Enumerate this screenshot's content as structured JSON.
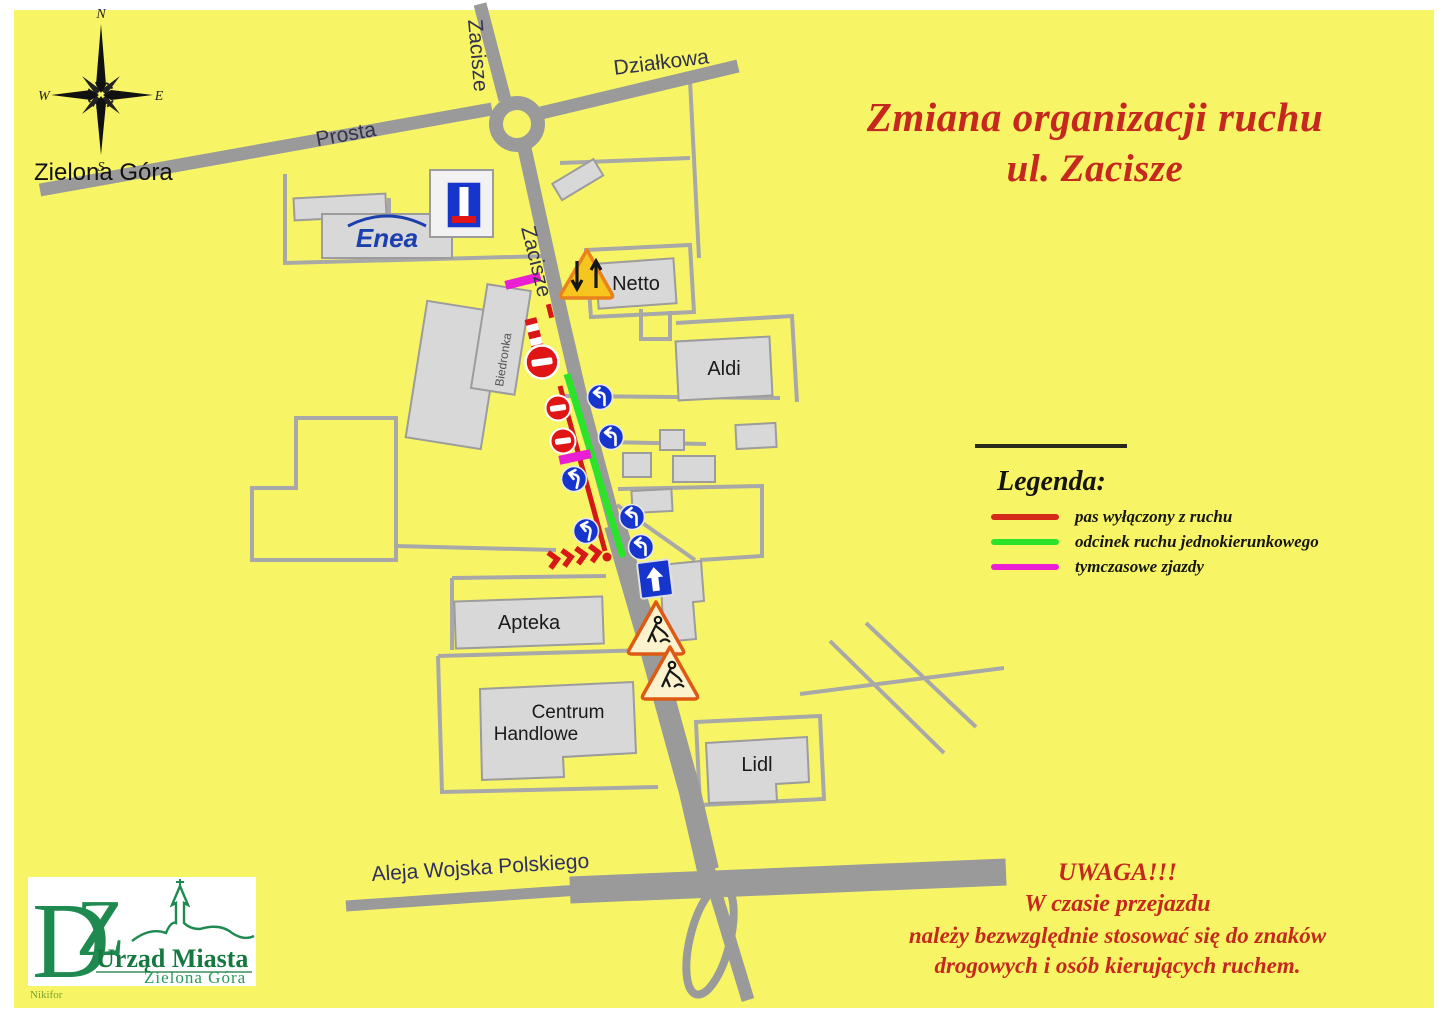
{
  "title": {
    "line1": "Zmiana organizacji ruchu",
    "line2": "ul. Zacisze"
  },
  "city_label": "Zielona Góra",
  "compass": {
    "north": "N",
    "east": "E",
    "south": "S",
    "west": "W"
  },
  "streets": {
    "prosta": "Prosta",
    "zacisze_top": "Zacisze",
    "zacisze_mid": "Zacisze",
    "dzialkowa": "Działkowa",
    "aleja": "Aleja Wojska Polskiego"
  },
  "buildings": {
    "enea": "Enea",
    "biedronka": "Biedronka",
    "netto": "Netto",
    "aldi": "Aldi",
    "apteka": "Apteka",
    "centrum_line1": "Centrum",
    "centrum_line2": "Handlowe",
    "lidl": "Lidl"
  },
  "legend": {
    "title": "Legenda:",
    "items": [
      {
        "color": "#d42a1a",
        "label": "pas wyłączony z ruchu"
      },
      {
        "color": "#2ce32c",
        "label": "odcinek ruchu jednokierunkowego"
      },
      {
        "color": "#ea1ed2",
        "label": "tymczasowe zjazdy"
      }
    ]
  },
  "warning": {
    "line1": "UWAGA!!!",
    "line2": "W czasie przejazdu",
    "line3": "należy bezwzględnie stosować się do znaków",
    "line4": "drogowych i osób kierujących ruchem."
  },
  "logo": {
    "letter_d": "D",
    "letter_z": "Z",
    "org": "Urząd Miasta",
    "city": "Zielona Góra",
    "signature": "Nikifor"
  },
  "signs": {
    "types": [
      "two-way-traffic-warning",
      "no-entry",
      "mandatory-turn",
      "one-way-straight",
      "road-works-warning",
      "no-through-road",
      "closed-lane-barrier",
      "direction-chevrons"
    ]
  },
  "colors": {
    "background": "#f7f565",
    "road": "#9a9a9a",
    "minor_road": "#a8a8a8",
    "building": "#d8d8d8",
    "title_red": "#c4281e",
    "closed_lane": "#d42a1a",
    "one_way": "#2ce32c",
    "temp_exit": "#ea1ed2",
    "sign_blue": "#1535cd",
    "logo_green": "#1e8a4f"
  }
}
